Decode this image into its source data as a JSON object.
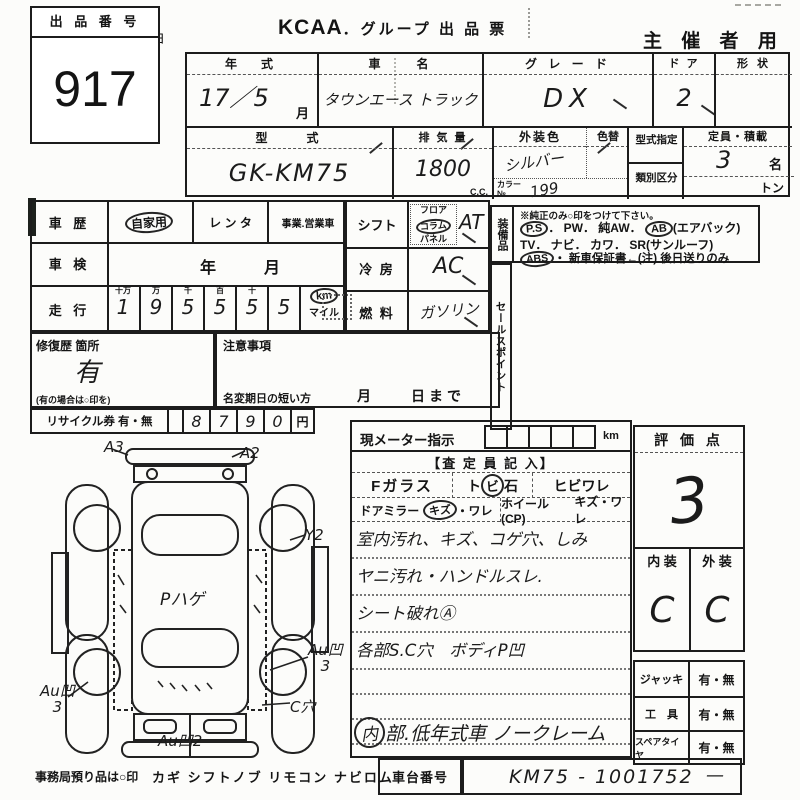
{
  "artifacts": {
    "stray_char": "ヨ"
  },
  "lot": {
    "label": "出 品 番 号",
    "number": "917"
  },
  "title": {
    "kcaa": "KCAA",
    "rest": "．グループ 出 品 票",
    "right": "主 催 者 用"
  },
  "vehicle": {
    "year_label": "年　式",
    "year_value": "17／5",
    "year_unit": "月",
    "name_label": "車　　名",
    "name_value": "タウンエース トラック",
    "grade_label": "グ レ ー ド",
    "grade_value": "DX",
    "door_label": "ド ア",
    "door_value": "2",
    "shape_label": "形 状",
    "model_label": "型　　式",
    "model_value": "GK-KM75",
    "disp_label": "排 気 量",
    "disp_value": "1800",
    "disp_unit": "C.C.",
    "ext_color_label": "外装色",
    "ext_color_value": "シルバー",
    "color_no_label1": "カラー",
    "color_no_label2": "№",
    "color_no_value": "199",
    "repaint_label": "色替",
    "type_spec_label": "型式指定",
    "class_label": "類別区分",
    "capacity_label": "定員・積載",
    "capacity_value": "3",
    "capacity_unit": "名",
    "load_unit": "トン"
  },
  "history": {
    "label": "車 歴",
    "opt1": "自家用",
    "opt2": "レ ン タ",
    "opt3": "事業.営業車",
    "shaken_label": "車 検",
    "shaken_year": "年",
    "shaken_month": "月",
    "mileage_label": "走 行",
    "digit_headers": [
      "十万",
      "万",
      "千",
      "百",
      "十",
      ""
    ],
    "digits": [
      "1",
      "9",
      "5",
      "5",
      "5",
      "5"
    ],
    "unit_km": "km",
    "unit_mile": "マイル",
    "repair_label": "修復歴 箇所",
    "repair_value": "有",
    "repair_note": "(有の場合は○印を)",
    "caution_label": "注意事項",
    "transfer_label": "名変期日の短い方",
    "transfer_value": "月　　日まで",
    "recycle_label": "リサイクル券 有・無",
    "recycle_digits": [
      "8",
      "7",
      "9",
      "0"
    ],
    "recycle_unit": "円"
  },
  "drivetrain": {
    "shift_label": "シフト",
    "shift_opt1": "フロア",
    "shift_opt2": "コラム",
    "shift_opt3": "パネル",
    "shift_value": "AT",
    "ac_label": "冷 房",
    "ac_value": "AC",
    "fuel_label": "燃 料",
    "fuel_value": "ガソリン"
  },
  "equip": {
    "label": "装備品",
    "note": "※純正のみ○印をつけて下さい。",
    "ps": "P.S",
    "l1a": "． PW． 純AW． ",
    "ab": "AB",
    "l1b": "(エアバック)",
    "l2": "TV． ナビ． カワ． SR(サンルーフ)",
    "abs": "ABS",
    "l3": "・ 新車保証書←(注) 後日送りのみ",
    "sales": "セールスポイント"
  },
  "insp": {
    "meter": "現メーター指示",
    "km": "km",
    "assessor": "【査 定 員 記 入】",
    "fg": "Fガラス",
    "fg1": "ト",
    "fg1c": "ビ",
    "fg2": "石",
    "fg3": "ヒビワレ",
    "dm": "ドアミラー",
    "dm1": "キズ",
    "dm2": "・ワレ",
    "wh": "ホイール(CP)",
    "wh1": "キズ・ワレ",
    "notes": [
      "室内汚れ、キズ、コゲ穴、しみ",
      "ヤニ汚れ・ハンドルスレ.",
      "シート破れⒶ",
      "各部S.C穴　ボディP凹"
    ],
    "low1": "内",
    "low2": "部.低年式車 ノークレーム"
  },
  "rating": {
    "label": "評 価 点",
    "score": "3",
    "interior_label": "内 装",
    "exterior_label": "外 装",
    "interior_value": "C",
    "exterior_value": "C"
  },
  "accessories": {
    "rows": [
      {
        "label": "ジャッキ",
        "value": "有・無"
      },
      {
        "label": "工　具",
        "value": "有・無"
      },
      {
        "label": "スペアタイヤ",
        "value": "有・無"
      }
    ]
  },
  "chassis": {
    "label": "車台番号",
    "value": "KM75 - 1001752",
    "dash": "—"
  },
  "diagram": {
    "annotations": [
      "A3",
      "A2",
      "Y2",
      "Pハゲ",
      "Au凹\n3",
      "Au凹\n3",
      "C穴",
      "Au凹2"
    ]
  },
  "footer": {
    "office_label": "事務局預り品は○印",
    "items": "カギ シフトノブ リモコン ナビロム"
  }
}
